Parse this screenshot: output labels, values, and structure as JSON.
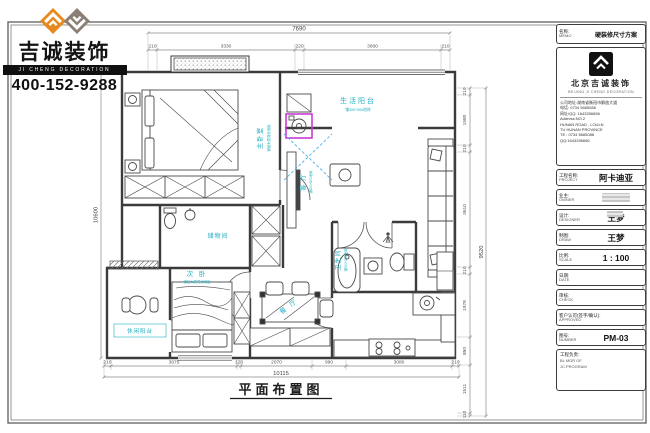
{
  "brand": {
    "name_cn": "吉诚装饰",
    "name_en": "JI CHENG DECORATION",
    "phone": "400-152-9288",
    "logo_icon": "double-diamond-logo",
    "colors": {
      "orange": "#E8891E",
      "gray": "#8A7F74"
    }
  },
  "drawing": {
    "title": "平面布置图",
    "accent_color": "#1FB0C4",
    "wall_color": "#3B3B3B",
    "highlight_color": "#C93BD4",
    "rooms": [
      {
        "label": "主卧室",
        "sub": "铺贴木质强化地板"
      },
      {
        "label": "生活阳台",
        "sub": "铺300*300地砖"
      },
      {
        "label": "客 厅",
        "sub": "铺800*800地砖"
      },
      {
        "label": "储物间",
        "sub": ""
      },
      {
        "label": "次 卧",
        "sub": "铺贴木质强化地板"
      },
      {
        "label": "休闲阳台",
        "sub": ""
      },
      {
        "label": "餐 厅",
        "sub": ""
      },
      {
        "label": "卫生间",
        "sub": "铺300*300地砖"
      }
    ],
    "dims": {
      "top_total": "7690",
      "top": [
        "210",
        "3330",
        "220",
        "3660",
        "210"
      ],
      "bottom": [
        "210",
        "3675",
        "120",
        "2070",
        "990",
        "3080",
        "210"
      ],
      "bottom_total": "10115",
      "right": [
        "210",
        "1580",
        "210",
        "3610",
        "210",
        "1978",
        "890",
        "1511",
        "110"
      ],
      "right_total": "9520",
      "left_total": "10600"
    }
  },
  "titleblock": {
    "name_row": {
      "label_cn": "名称:",
      "label_en": "MEMO",
      "value": "硬装修尺寸方案"
    },
    "company": {
      "cn": "北京吉诚装饰",
      "en": "BEIJING JI CHENG DECORATION"
    },
    "info_lines": [
      "公司地址:湖南省衡阳市解放大道",
      "电话: 0734 5685088",
      "网址/QQ: 1643256656",
      "Address:NO.2",
      "HUNAN ROAD , LOULN",
      "TU HUNAN PROVINCE",
      "TE : 0734 5685088",
      "QQ:1643256656"
    ],
    "rows": [
      {
        "label_cn": "工程名称:",
        "label_en": "PROJECT",
        "value": "阿卡迪亚"
      },
      {
        "label_cn": "业主:",
        "label_en": "OWNER",
        "value": ""
      },
      {
        "label_cn": "设计:",
        "label_en": "DESIGNER",
        "value": "王梦"
      },
      {
        "label_cn": "制图:",
        "label_en": "DRAW",
        "value": "王梦"
      },
      {
        "label_cn": "比例:",
        "label_en": "SCALE",
        "value": "1 : 100"
      },
      {
        "label_cn": "日期:",
        "label_en": "DATE",
        "value": ""
      },
      {
        "label_cn": "审核:",
        "label_en": "CHECK",
        "value": ""
      },
      {
        "label_cn": "客户认可(签字/确认):",
        "label_en": "APPROVED",
        "value": ""
      },
      {
        "label_cn": "图号:",
        "label_en": "NUMBER",
        "value": "PM-03"
      }
    ],
    "footer": {
      "label_cn": "工程负责:",
      "line1": "BL MGR OF",
      "line2": "JC.PROGRAM"
    }
  }
}
